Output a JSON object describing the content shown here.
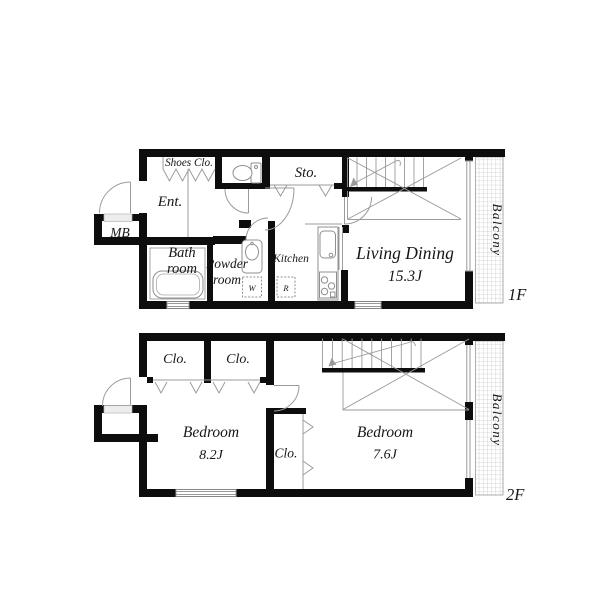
{
  "colors": {
    "wall": "#0d0d0d",
    "line": "#8f8f8f",
    "fixture": "#8f8f8f",
    "hatch": "#c9c9c9",
    "text": "#161616",
    "background": "#ffffff"
  },
  "floor1": {
    "floor_label": "1F",
    "shoes_closet_label": "Shoes Clo.",
    "entrance_label": "Ent.",
    "meter_box_label": "MB",
    "storage_label": "Sto.",
    "bathroom_label_line1": "Bath",
    "bathroom_label_line2": "room",
    "powder_room_label_line1": "Powder",
    "powder_room_label_line2": "room",
    "washing_machine_label": "W",
    "refrigerator_label": "R",
    "kitchen_label": "Kitchen",
    "living_dining_label": "Living Dining",
    "living_dining_size": "15.3J",
    "balcony_label": "Balcony"
  },
  "floor2": {
    "floor_label": "2F",
    "closet_left_label": "Clo.",
    "closet_right_label": "Clo.",
    "closet_center_label": "Clo.",
    "bedroom_left_label": "Bedroom",
    "bedroom_left_size": "8.2J",
    "bedroom_right_label": "Bedroom",
    "bedroom_right_size": "7.6J",
    "balcony_label": "Balcony"
  }
}
